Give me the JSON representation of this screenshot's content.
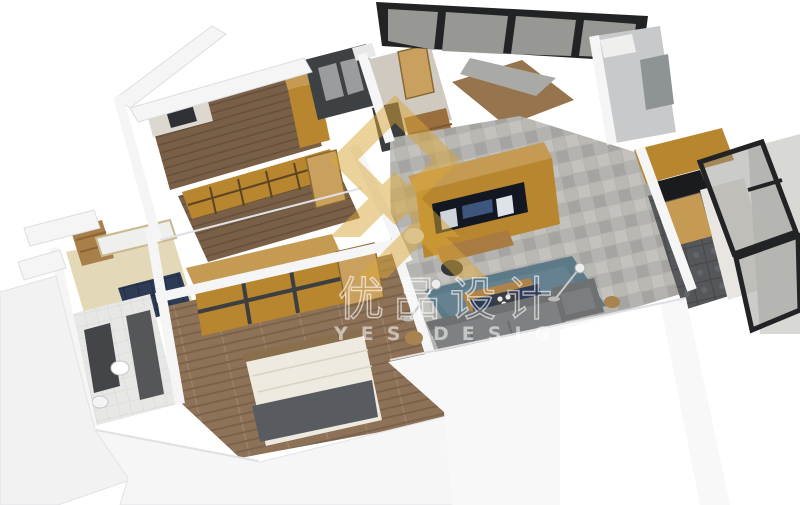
{
  "scene": {
    "type": "3d-isometric-floorplan-render",
    "background": "#ffffff"
  },
  "watermark": {
    "brand_cn": "优品设计",
    "brand_en": "YES DESIGN",
    "logo": "gold-chevron-diamond"
  },
  "palette": {
    "wall": "#f5f5f6",
    "wallShade": "#dfe1e4",
    "wallDeep": "#e9eaec",
    "oak": "#b8862f",
    "oakLight": "#c59a52",
    "doorWood": "#c9a05e",
    "plankDark": "#7a5f47",
    "plankBed": "#8d7257",
    "tileLiving": "#b4b3af",
    "tileDark": "#55575a",
    "shower": "#3e4144",
    "navy": "#2e3b55",
    "rug": "#5d7a88",
    "sofa": "#7e8081",
    "sofaDark": "#6e7071",
    "cream": "#e3d9b8",
    "whiteTile": "#e7e7e5",
    "glass": "#8c8e88",
    "frame": "#212325",
    "gold": "#d9a637",
    "marble": "#e9e6e1",
    "roofPane": "#979793",
    "tvScreen": "#131722",
    "mattress": "#eeeadf",
    "blanket": "#585c60"
  }
}
